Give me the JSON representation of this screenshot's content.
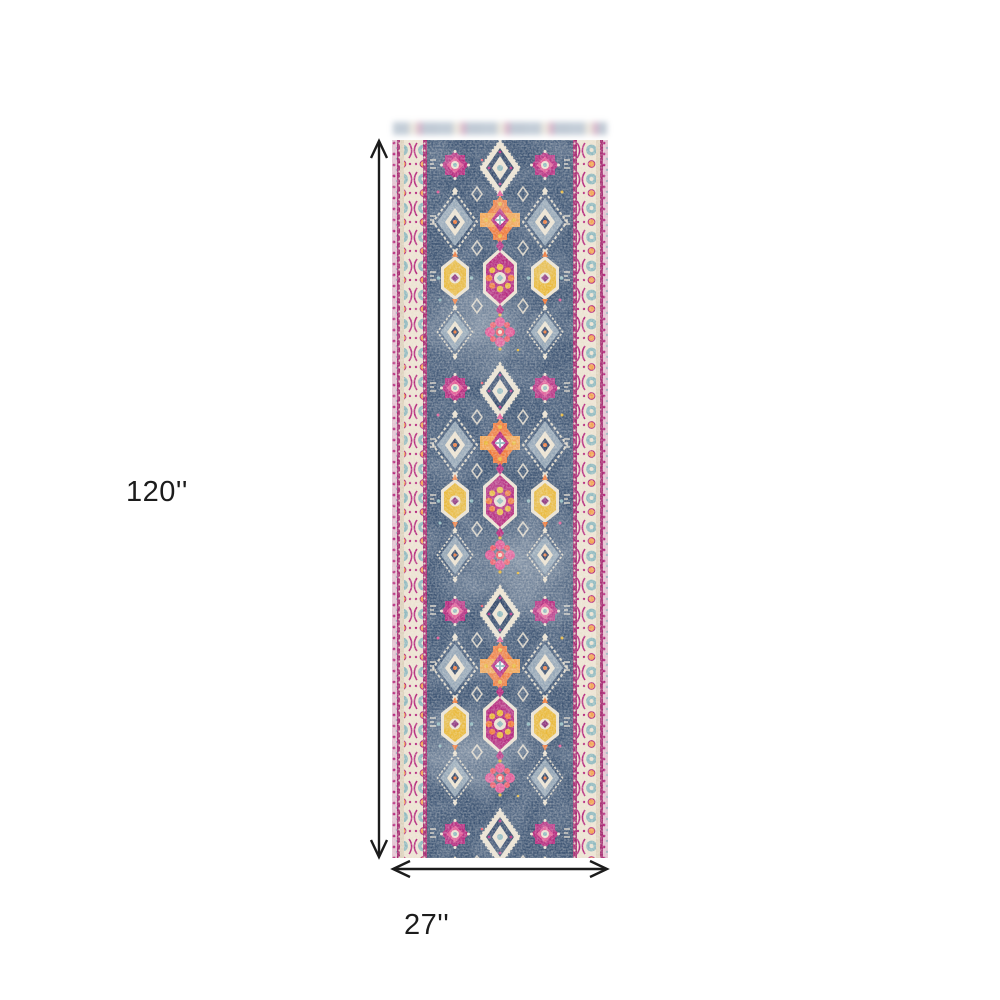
{
  "page": {
    "background_color": "#ffffff"
  },
  "product_diagram": {
    "subject": "vintage oriental runner rug",
    "height_label": "120''",
    "width_label": "27''",
    "arrow_color": "#1c1c1c",
    "label_color": "#1c1c1c"
  },
  "rug_palette": {
    "field_navy": "#3e5574",
    "field_dark": "#32486a",
    "field_light": "#7a8fa8",
    "cream": "#ece3d2",
    "cream_dark": "#ddd2bd",
    "magenta": "#b5297e",
    "pink": "#e25795",
    "coral": "#ee5a6a",
    "orange": "#ef7b3d",
    "apricot": "#f2a451",
    "yellow": "#e9b93c",
    "teal": "#8fb9bf",
    "gray_blue": "#a0b1bf",
    "plum": "#8a2f7a",
    "guard_magenta": "#a62c72",
    "edge_pink": "#e3c3d2"
  }
}
